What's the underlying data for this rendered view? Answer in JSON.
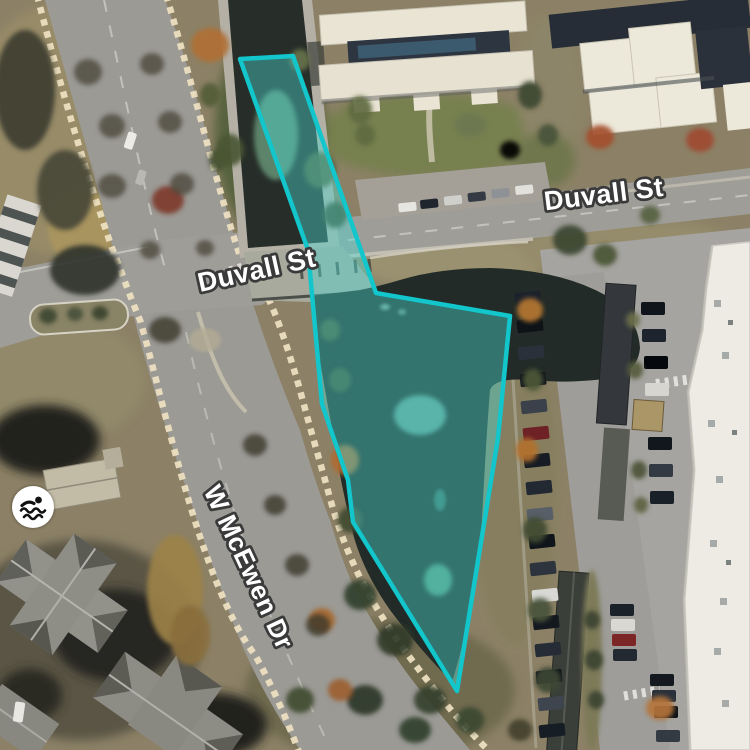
{
  "map": {
    "street_labels": [
      {
        "text": "Duvall St"
      },
      {
        "text": "Duvall St"
      },
      {
        "text": "W McEwen Dr"
      }
    ],
    "poi": {
      "label": "swimming",
      "icon": "swimmer-icon"
    },
    "selection_overlay": {
      "stroke_color": "#12c6cb",
      "fill_color": "rgba(76,217,209,0.42)",
      "points": [
        [
          240,
          59
        ],
        [
          293,
          56
        ],
        [
          376,
          293
        ],
        [
          510,
          316
        ],
        [
          498,
          438
        ],
        [
          483,
          530
        ],
        [
          470,
          610
        ],
        [
          457,
          691
        ],
        [
          353,
          522
        ],
        [
          348,
          480
        ],
        [
          322,
          404
        ],
        [
          308,
          250
        ]
      ]
    }
  }
}
